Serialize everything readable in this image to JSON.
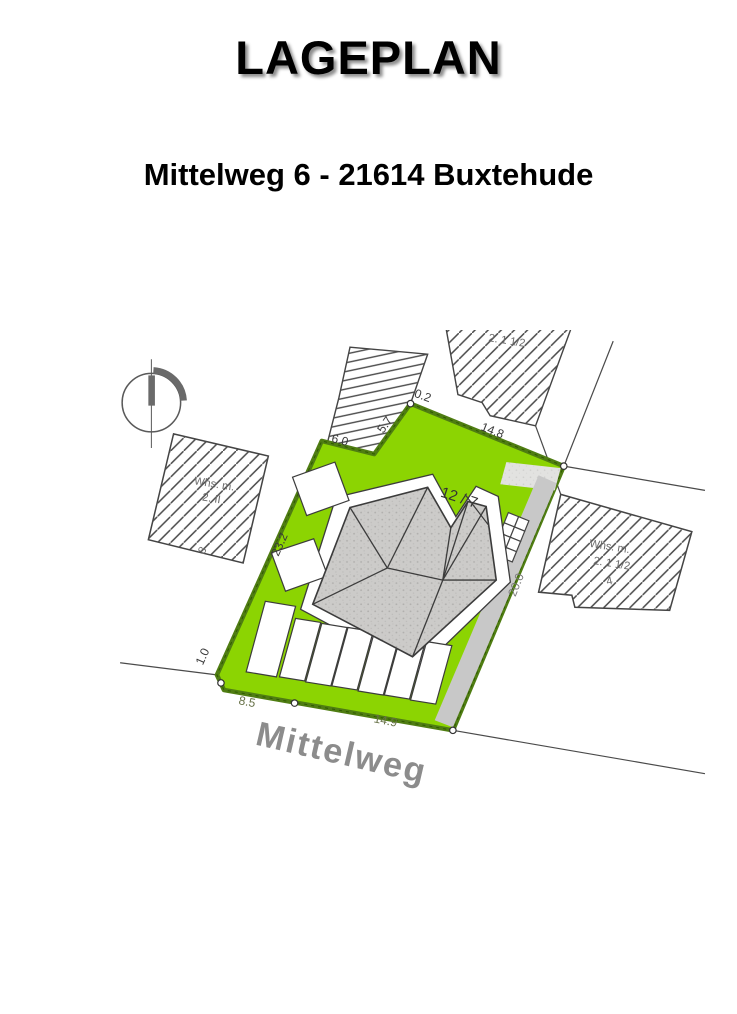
{
  "page": {
    "title": "LAGEPLAN",
    "subtitle": "Mittelweg 6 - 21614 Buxtehude"
  },
  "plan": {
    "street_name": "Mittelweg",
    "parcel_number": "12 / 7",
    "dimensions": {
      "top_step": "0.2",
      "top_edge": "14.8",
      "notch_top": "6.0",
      "notch_side": "5.7",
      "left_edge": "23.2",
      "bottom_step": "1.0",
      "bottom_left_edge": "8.5",
      "bottom_edge": "14.9",
      "driveway": "20.0"
    },
    "buildings": {
      "west": {
        "line1": "Whs. m.",
        "line2": "2. II",
        "house_number": "8"
      },
      "east": {
        "line1": "Whs. m.",
        "line2": "2. 1 1/2",
        "house_number": "4"
      },
      "north_east_partial": "2. 1 1/2"
    },
    "colors": {
      "parcel_green": "#8cd402",
      "parcel_border": "#4f7d12",
      "roof_gray": "#cccbc9",
      "driveway_gray": "#c8c8c8",
      "street_label_gray": "#8c8c8c"
    }
  }
}
